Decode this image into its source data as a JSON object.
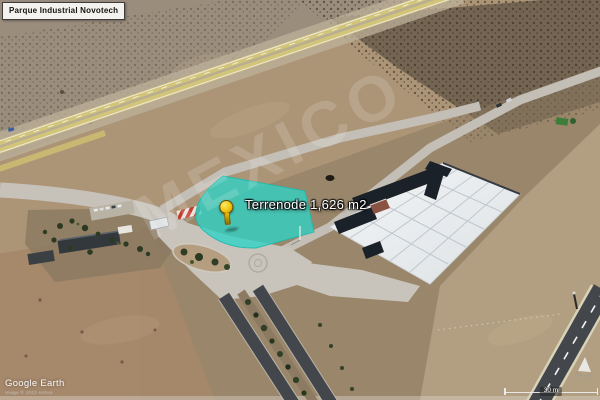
{
  "app": {
    "logo_text": "Google Earth",
    "attribution_text": "Image © 2023 Airbus"
  },
  "overlay_title": {
    "text": "Parque Industrial Novotech"
  },
  "placemark": {
    "label": "Terrenode 1,626 m2",
    "pin_color": "#f2c40e"
  },
  "parcel_highlight": {
    "fill": "#2ed3c6",
    "outline": "#1fb9ad",
    "opacity": 0.78
  },
  "scale_bar": {
    "label": "30 m"
  },
  "watermark": {
    "text": "MEXICO"
  },
  "scene_colors": {
    "terrain_base": "#ac9477",
    "terrain_gray": "#9b8d7c",
    "scrub_dark": "#6a5d4b",
    "highway_yellow": "#d2c479",
    "road_concrete": "#c7c2b9",
    "asphalt_dark": "#43464b",
    "slab_white": "#e9ecee",
    "slab_dark_sections": "#1b2129"
  }
}
